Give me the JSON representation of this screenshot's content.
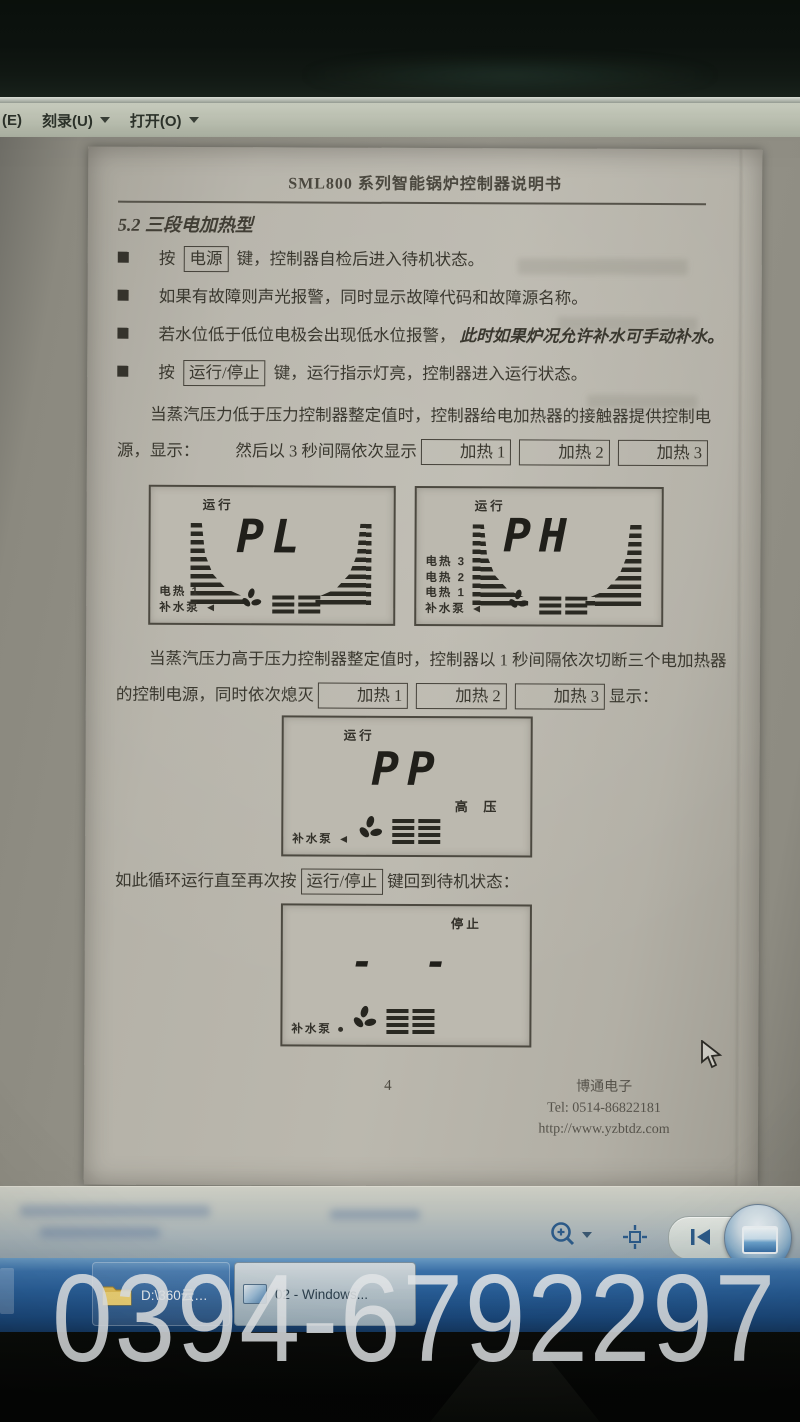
{
  "menubar": {
    "item_e": "(E)",
    "item_burn": "刻录(U)",
    "item_open": "打开(O)"
  },
  "document": {
    "header_title": "SML800 系列智能锅炉控制器说明书",
    "section_title": "5.2 三段电加热型",
    "bullets": {
      "b1_pre": "按",
      "b1_key": "电源",
      "b1_post": "键，控制器自检后进入待机状态。",
      "b2": "如果有故障则声光报警，同时显示故障代码和故障源名称。",
      "b3_pre": "若水位低于低位电极会出现低水位报警，",
      "b3_italic": "此时如果炉况允许补水可手动补水。",
      "b4_pre": "按",
      "b4_key": "运行/停止",
      "b4_post": "键，运行指示灯亮，控制器进入运行状态。"
    },
    "para1": {
      "text1": "当蒸汽压力低于压力控制器整定值时，控制器给电加热器的接触器提供控制电源，显示：",
      "text2": "然后以 3 秒间隔依次显示",
      "key1": "加热 1",
      "key2": "加热 2",
      "key3": "加热 3"
    },
    "para2": {
      "text1": "当蒸汽压力高于压力控制器整定值时，控制器以 1 秒间隔依次切断三个电加热器的控制电源，同时依次熄灭",
      "key1": "加热 1",
      "key2": "加热 2",
      "key3": "加热 3",
      "text2": "显示："
    },
    "loop_line": {
      "pre": "如此循环运行直至再次按",
      "key": "运行/停止",
      "post": "键回到待机状态："
    },
    "footer": {
      "page_number": "4",
      "company": "博通电子",
      "tel": "Tel: 0514-86822181",
      "url": "http://www.yzbtdz.com"
    }
  },
  "lcds": [
    {
      "status": "运行",
      "digits": "PL",
      "labels": [
        "电热 1",
        "补水泵 ◄"
      ]
    },
    {
      "status": "运行",
      "digits": "PH",
      "labels": [
        "电热 3",
        "电热 2",
        "电热 1",
        "补水泵 ◄"
      ]
    },
    {
      "status": "运行",
      "digits": "PP",
      "side_label": "高  压",
      "labels": [
        "补水泵 ◄"
      ]
    },
    {
      "status": "停止",
      "digits": "- -",
      "labels": [
        "补水泵 ●"
      ]
    }
  ],
  "taskbar": {
    "button1": "D:\\360云盘(仪表...",
    "button2": "02 - Windows..."
  },
  "watermark": "0394-6792297"
}
